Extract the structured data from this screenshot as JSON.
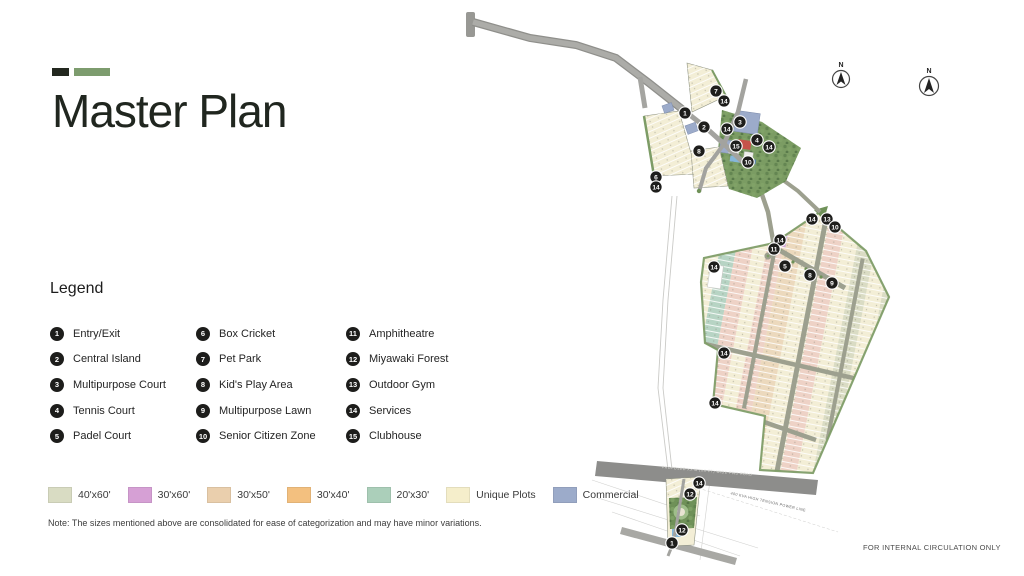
{
  "header": {
    "title": "Master Plan"
  },
  "legend": {
    "heading": "Legend",
    "items": [
      {
        "num": "1",
        "label": "Entry/Exit"
      },
      {
        "num": "2",
        "label": "Central Island"
      },
      {
        "num": "3",
        "label": "Multipurpose Court"
      },
      {
        "num": "4",
        "label": "Tennis Court"
      },
      {
        "num": "5",
        "label": "Padel Court"
      },
      {
        "num": "6",
        "label": "Box Cricket"
      },
      {
        "num": "7",
        "label": "Pet Park"
      },
      {
        "num": "8",
        "label": "Kid's Play Area"
      },
      {
        "num": "9",
        "label": "Multipurpose Lawn"
      },
      {
        "num": "10",
        "label": "Senior Citizen Zone"
      },
      {
        "num": "11",
        "label": "Amphitheatre"
      },
      {
        "num": "12",
        "label": "Miyawaki Forest"
      },
      {
        "num": "13",
        "label": "Outdoor Gym"
      },
      {
        "num": "14",
        "label": "Services"
      },
      {
        "num": "15",
        "label": "Clubhouse"
      }
    ]
  },
  "plot_types": [
    {
      "label": "40'x60'",
      "color": "#d9dcc3"
    },
    {
      "label": "30'x60'",
      "color": "#d6a0d5"
    },
    {
      "label": "30'x50'",
      "color": "#eacfad"
    },
    {
      "label": "30'x40'",
      "color": "#f3c07f"
    },
    {
      "label": "20'x30'",
      "color": "#abcfba"
    },
    {
      "label": "Unique Plots",
      "color": "#f5eecb"
    },
    {
      "label": "Commercial",
      "color": "#9cabca"
    }
  ],
  "note": "Note: The sizes mentioned above are consolidated for ease of categorization and may have minor variations.",
  "footer": {
    "circulation": "FOR INTERNAL CIRCULATION ONLY"
  },
  "map": {
    "compass_label": "N",
    "road_label": "PROPOSED XX M (XX FT) WIDE PWD ROAD",
    "power_label": "400 KVA HIGH TENSION POWER LINE",
    "markers": [
      {
        "n": "7",
        "x": 716,
        "y": 91
      },
      {
        "n": "14",
        "x": 724,
        "y": 101
      },
      {
        "n": "1",
        "x": 685,
        "y": 113
      },
      {
        "n": "2",
        "x": 704,
        "y": 127
      },
      {
        "n": "3",
        "x": 740,
        "y": 122
      },
      {
        "n": "14",
        "x": 727,
        "y": 129
      },
      {
        "n": "4",
        "x": 757,
        "y": 140
      },
      {
        "n": "15",
        "x": 736,
        "y": 146
      },
      {
        "n": "14",
        "x": 769,
        "y": 147
      },
      {
        "n": "8",
        "x": 699,
        "y": 151
      },
      {
        "n": "10",
        "x": 748,
        "y": 162
      },
      {
        "n": "6",
        "x": 656,
        "y": 177
      },
      {
        "n": "14",
        "x": 656,
        "y": 187
      },
      {
        "n": "14",
        "x": 812,
        "y": 219
      },
      {
        "n": "13",
        "x": 827,
        "y": 219
      },
      {
        "n": "10",
        "x": 835,
        "y": 227
      },
      {
        "n": "14",
        "x": 780,
        "y": 240
      },
      {
        "n": "11",
        "x": 774,
        "y": 249
      },
      {
        "n": "14",
        "x": 714,
        "y": 267
      },
      {
        "n": "5",
        "x": 785,
        "y": 266
      },
      {
        "n": "8",
        "x": 810,
        "y": 275
      },
      {
        "n": "9",
        "x": 832,
        "y": 283
      },
      {
        "n": "14",
        "x": 724,
        "y": 353
      },
      {
        "n": "14",
        "x": 715,
        "y": 403
      },
      {
        "n": "14",
        "x": 699,
        "y": 483
      },
      {
        "n": "12",
        "x": 690,
        "y": 494
      },
      {
        "n": "12",
        "x": 682,
        "y": 530
      },
      {
        "n": "1",
        "x": 672,
        "y": 543
      }
    ]
  }
}
